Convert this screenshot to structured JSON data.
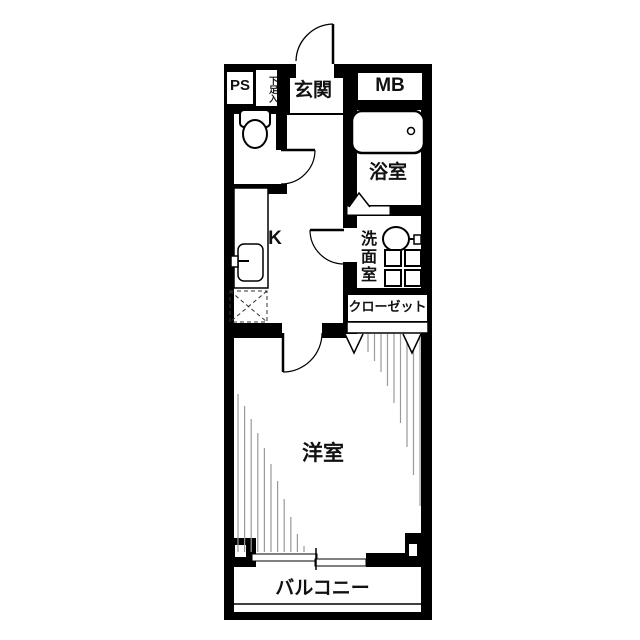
{
  "floor_plan": {
    "type": "japanese-apartment-floor-plan",
    "labels": {
      "ps": "PS",
      "shoe_cabinet": "下足入",
      "entrance": "玄関",
      "meter_box": "MB",
      "bathroom": "浴室",
      "washroom": "洗面室",
      "kitchen": "K",
      "closet": "クローゼット",
      "western_room": "洋室",
      "balcony": "バルコニー"
    },
    "colors": {
      "wall": "#000000",
      "floor": "#ffffff",
      "hatch": "#9a9a9a"
    }
  }
}
